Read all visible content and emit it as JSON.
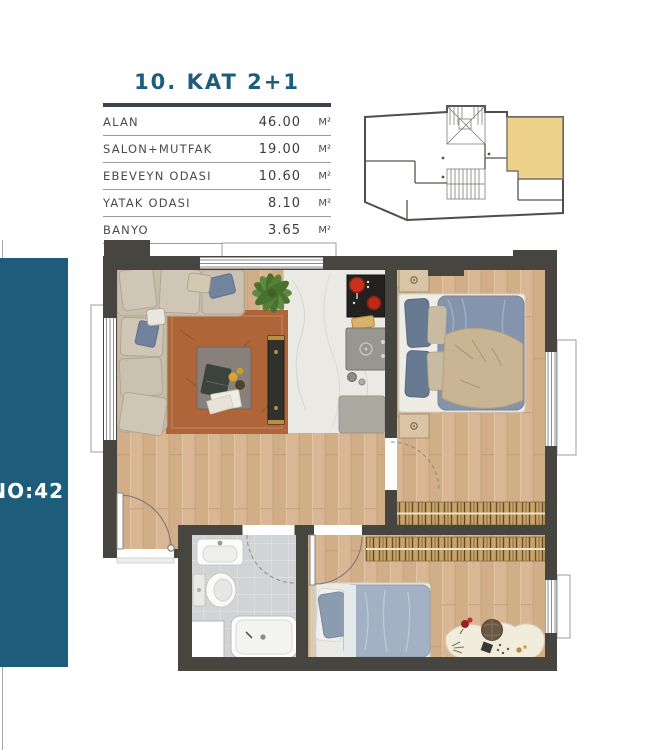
{
  "header": {
    "title": "10. KAT 2+1"
  },
  "area_table": {
    "rows": [
      {
        "label": "ALAN",
        "value": "46.00",
        "unit": "M²"
      },
      {
        "label": "SALON+MUTFAK",
        "value": "19.00",
        "unit": "M²"
      },
      {
        "label": "EBEVEYN ODASI",
        "value": "10.60",
        "unit": "M²"
      },
      {
        "label": "YATAK ODASI",
        "value": "8.10",
        "unit": "M²"
      },
      {
        "label": "BANYO",
        "value": "3.65",
        "unit": "M²"
      }
    ]
  },
  "badge": {
    "label": "NO:42"
  },
  "key_plan": {
    "name": "building-key-plan",
    "highlighted_unit": "top-right"
  },
  "floor_plan": {
    "elements": [
      "sofa",
      "rug",
      "coffee-table",
      "tv-unit",
      "plant",
      "kitchen-island",
      "stove",
      "kitchen-sink",
      "master-bed",
      "nightstands",
      "wardrobes",
      "single-bed",
      "desk",
      "pouf",
      "bathroom-sink",
      "toilet",
      "shower",
      "washing-machine",
      "windows",
      "doors"
    ]
  },
  "colors": {
    "accent": "#1d5d7b",
    "rule": "#3a424e",
    "wall": "#46453f",
    "wood": "#d8b592",
    "yellow": "#eed28b",
    "rug": "#b06538",
    "bedding": "#8394ac",
    "tile": "#d2d3d6",
    "text": "#4a4a4a",
    "line": "#9a9a9a"
  }
}
